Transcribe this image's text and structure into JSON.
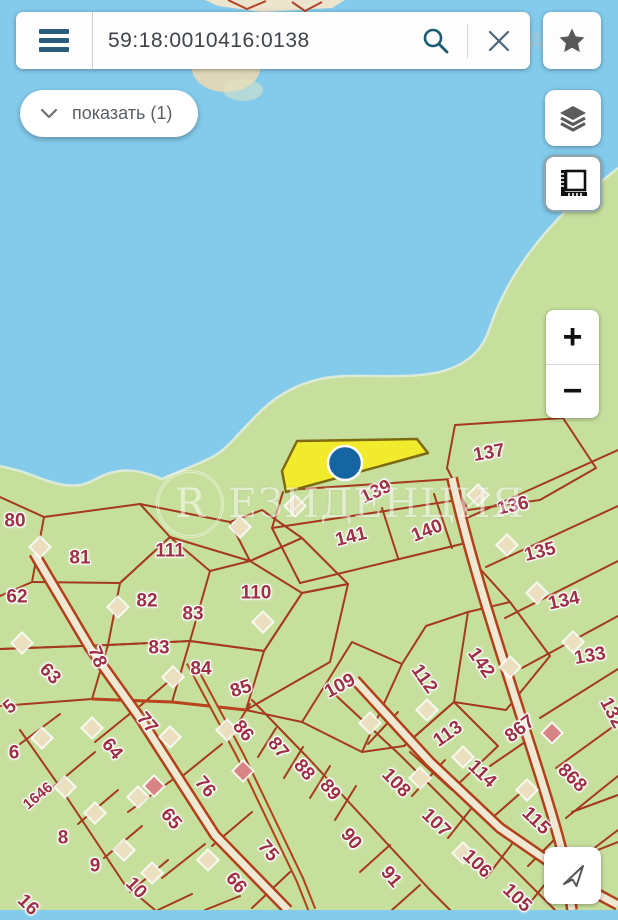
{
  "header": {
    "search_value": "59:18:0010416:0138",
    "icons": [
      "menu-icon",
      "search-icon",
      "clear-icon",
      "favorite-star-icon"
    ],
    "watermark_fragment": "РЕАТ"
  },
  "toolbar": {
    "show_filter_label": "показать (1)"
  },
  "controls": {
    "zoom_in_label": "+",
    "zoom_out_label": "−",
    "icons": [
      "layers-icon",
      "measure-icon",
      "locate-arrow-icon"
    ]
  },
  "map": {
    "watermark": {
      "letter": "R",
      "text": "ЕЗИДЕНЦИЯ"
    },
    "colors": {
      "lake": "#84cbeb",
      "land": "#c6df9d",
      "parcel_line": "#a5391d",
      "parcel_label": "#9e3044",
      "highlight_parcel": "#f2ea2d",
      "marker": "#1565a3"
    },
    "selected_parcel": {
      "marker": "blue-dot",
      "x": 345,
      "y": 463
    },
    "parcels": [
      {
        "t": "80",
        "x": 15,
        "y": 521,
        "r": 0
      },
      {
        "t": "81",
        "x": 80,
        "y": 558,
        "r": 0
      },
      {
        "t": "62",
        "x": 17,
        "y": 597,
        "r": 0
      },
      {
        "t": "111",
        "x": 170,
        "y": 551,
        "r": 0
      },
      {
        "t": "82",
        "x": 147,
        "y": 601,
        "r": 0
      },
      {
        "t": "83",
        "x": 193,
        "y": 614,
        "r": 0
      },
      {
        "t": "110",
        "x": 256,
        "y": 593,
        "r": 0
      },
      {
        "t": "83",
        "x": 159,
        "y": 648,
        "r": 0
      },
      {
        "t": "84",
        "x": 201,
        "y": 669,
        "r": 0
      },
      {
        "t": "85",
        "x": 241,
        "y": 689,
        "r": -18
      },
      {
        "t": "78",
        "x": 97,
        "y": 657,
        "r": 68
      },
      {
        "t": "63",
        "x": 50,
        "y": 674,
        "r": 45
      },
      {
        "t": "139",
        "x": 376,
        "y": 492,
        "r": -25
      },
      {
        "t": "141",
        "x": 351,
        "y": 537,
        "r": -14
      },
      {
        "t": "140",
        "x": 427,
        "y": 531,
        "r": -22
      },
      {
        "t": "137",
        "x": 489,
        "y": 453,
        "r": -10
      },
      {
        "t": "136",
        "x": 513,
        "y": 506,
        "r": -12
      },
      {
        "t": "135",
        "x": 540,
        "y": 552,
        "r": -14
      },
      {
        "t": "134",
        "x": 564,
        "y": 601,
        "r": -12
      },
      {
        "t": "133",
        "x": 590,
        "y": 656,
        "r": -10
      },
      {
        "t": "142",
        "x": 481,
        "y": 663,
        "r": 55
      },
      {
        "t": "112",
        "x": 424,
        "y": 679,
        "r": 55
      },
      {
        "t": "109",
        "x": 340,
        "y": 686,
        "r": -28
      },
      {
        "t": "113",
        "x": 448,
        "y": 734,
        "r": -35
      },
      {
        "t": "867",
        "x": 520,
        "y": 729,
        "r": -38
      },
      {
        "t": "132",
        "x": 612,
        "y": 713,
        "r": 62
      },
      {
        "t": "5",
        "x": 10,
        "y": 707,
        "r": -40
      },
      {
        "t": "77",
        "x": 147,
        "y": 723,
        "r": 50
      },
      {
        "t": "86",
        "x": 243,
        "y": 731,
        "r": 50
      },
      {
        "t": "87",
        "x": 278,
        "y": 748,
        "r": 50
      },
      {
        "t": "6",
        "x": 14,
        "y": 753,
        "r": 0
      },
      {
        "t": "64",
        "x": 112,
        "y": 749,
        "r": 50
      },
      {
        "t": "1646",
        "x": 38,
        "y": 796,
        "r": -40,
        "s": 15
      },
      {
        "t": "76",
        "x": 205,
        "y": 787,
        "r": 50
      },
      {
        "t": "8",
        "x": 63,
        "y": 838,
        "r": 0
      },
      {
        "t": "65",
        "x": 171,
        "y": 819,
        "r": 50
      },
      {
        "t": "9",
        "x": 95,
        "y": 866,
        "r": 0
      },
      {
        "t": "75",
        "x": 268,
        "y": 851,
        "r": 50
      },
      {
        "t": "10",
        "x": 136,
        "y": 888,
        "r": 46
      },
      {
        "t": "66",
        "x": 236,
        "y": 883,
        "r": 50
      },
      {
        "t": "16",
        "x": 28,
        "y": 905,
        "r": 45
      },
      {
        "t": "88",
        "x": 304,
        "y": 770,
        "r": 50
      },
      {
        "t": "89",
        "x": 330,
        "y": 790,
        "r": 50
      },
      {
        "t": "108",
        "x": 396,
        "y": 783,
        "r": 46
      },
      {
        "t": "114",
        "x": 482,
        "y": 774,
        "r": 44
      },
      {
        "t": "868",
        "x": 572,
        "y": 778,
        "r": 44
      },
      {
        "t": "90",
        "x": 351,
        "y": 839,
        "r": 50
      },
      {
        "t": "107",
        "x": 436,
        "y": 823,
        "r": 44
      },
      {
        "t": "115",
        "x": 536,
        "y": 821,
        "r": 44
      },
      {
        "t": "91",
        "x": 391,
        "y": 877,
        "r": 50
      },
      {
        "t": "106",
        "x": 477,
        "y": 864,
        "r": 44
      },
      {
        "t": "105",
        "x": 517,
        "y": 898,
        "r": 44
      }
    ],
    "buildings": [
      {
        "x": 40,
        "y": 547
      },
      {
        "x": 240,
        "y": 527
      },
      {
        "x": 295,
        "y": 506
      },
      {
        "x": 118,
        "y": 607
      },
      {
        "x": 263,
        "y": 622
      },
      {
        "x": 22,
        "y": 643
      },
      {
        "x": 173,
        "y": 677
      },
      {
        "x": 92,
        "y": 728
      },
      {
        "x": 42,
        "y": 738
      },
      {
        "x": 170,
        "y": 737
      },
      {
        "x": 227,
        "y": 730
      },
      {
        "x": 65,
        "y": 787
      },
      {
        "x": 95,
        "y": 813
      },
      {
        "x": 138,
        "y": 797
      },
      {
        "x": 124,
        "y": 850
      },
      {
        "x": 208,
        "y": 860
      },
      {
        "x": 152,
        "y": 873
      },
      {
        "x": 154,
        "y": 786,
        "c": "p"
      },
      {
        "x": 243,
        "y": 771,
        "c": "p"
      },
      {
        "x": 370,
        "y": 723
      },
      {
        "x": 427,
        "y": 710
      },
      {
        "x": 510,
        "y": 667
      },
      {
        "x": 463,
        "y": 757
      },
      {
        "x": 552,
        "y": 733,
        "c": "p"
      },
      {
        "x": 478,
        "y": 495
      },
      {
        "x": 507,
        "y": 545
      },
      {
        "x": 537,
        "y": 593
      },
      {
        "x": 573,
        "y": 642
      },
      {
        "x": 420,
        "y": 778
      },
      {
        "x": 463,
        "y": 853
      },
      {
        "x": 527,
        "y": 790
      }
    ]
  }
}
